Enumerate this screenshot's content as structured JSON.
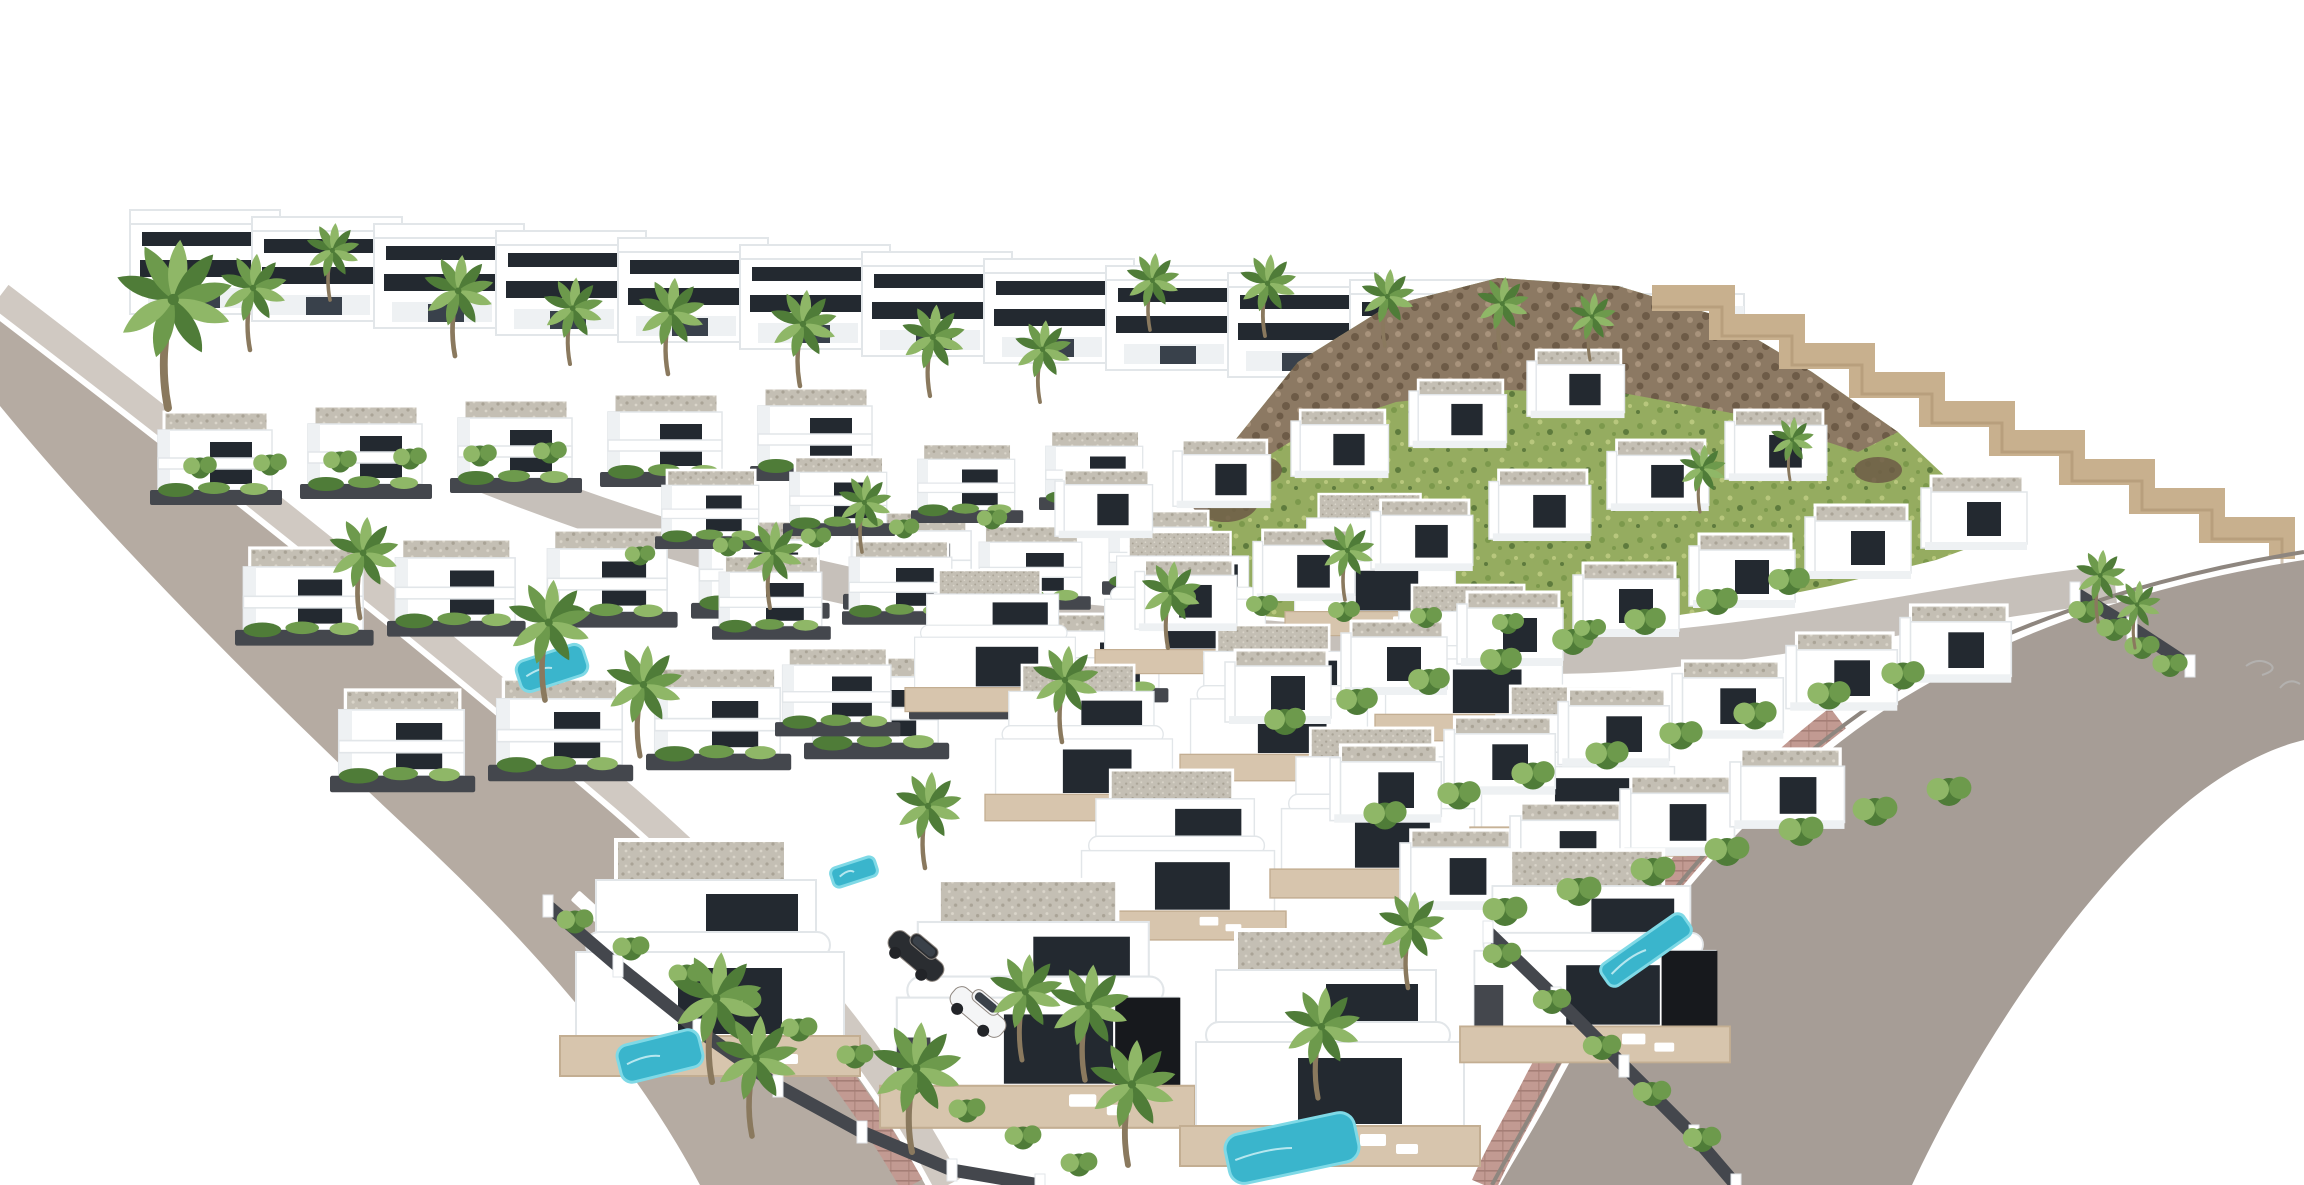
{
  "meta": {
    "title": "Aerial 3D architectural render of a white villa development with palm trees, pools and roads"
  },
  "canvas": {
    "width": 2304,
    "height": 1185,
    "background": "#ffffff"
  },
  "palette": {
    "white": "#ffffff",
    "offWhite": "#eef1f3",
    "shade": "#e2e6e9",
    "glass": "#232930",
    "glassLight": "#39414b",
    "black": "#17191d",
    "roadLeft": "#b5aba2",
    "roadRight": "#a69d96",
    "sidewalk": "#d0c9c2",
    "curbDark": "#8e867f",
    "pink": "#c29a92",
    "pinkLine": "#a57e76",
    "gravelBase": "#c4bfb4",
    "gravelDot1": "#a9a396",
    "gravelDot2": "#dad5ca",
    "wallDark": "#44474d",
    "terrace": "#d7c5ad",
    "terraceLine": "#c3ae92",
    "grassBase": "#95ac60",
    "grassDot1": "#7c994c",
    "grassDot2": "#b8c77d",
    "grassDark": "#5e7b3d",
    "rockBase": "#8c7963",
    "rockDot1": "#6d5b47",
    "rockDot2": "#a8937c",
    "stone": "#c8b08e",
    "stoneLine": "#a88e6c",
    "green1": "#6d9a4c",
    "green2": "#4f7c38",
    "green3": "#8fb767",
    "trunk": "#8a795e",
    "pool": "#3ab5cc",
    "poolLight": "#7fd9e6",
    "carDark": "#2a2d31",
    "carWhite": "#f4f5f6",
    "carGlass": "#3a4149"
  },
  "scene": {
    "top_row": {
      "n": 13,
      "x": 130,
      "y": 210,
      "dx": 122,
      "dy": 7
    },
    "hill": {
      "points": "1185,642 1202,524 1232,444 1298,362 1388,306 1498,278 1618,286 1718,316 1812,372 1898,432 1962,492 2002,536 1936,560 1830,586 1700,612 1560,632 1410,646 1270,650",
      "ridge": "1232,444 1298,362 1388,306 1498,278 1618,286 1718,316 1812,372 1898,432 1858,452 1748,416 1628,394 1508,390 1396,402 1306,432 1258,462",
      "rocks": [
        {
          "cx": 1225,
          "cy": 500,
          "rx": 34,
          "ry": 22
        },
        {
          "cx": 1208,
          "cy": 560,
          "rx": 26,
          "ry": 16
        },
        {
          "cx": 1260,
          "cy": 470,
          "rx": 22,
          "ry": 14
        },
        {
          "cx": 1950,
          "cy": 520,
          "rx": 30,
          "ry": 16
        },
        {
          "cx": 1878,
          "cy": 470,
          "rx": 24,
          "ry": 13
        }
      ]
    },
    "stone_wall": {
      "x": 1652,
      "y": 298,
      "steps": 9,
      "dx": 70,
      "dy": 29,
      "width": 26
    },
    "center_road": {
      "path": "M470,468 C700,560 905,608 1115,626 C1335,645 1490,662 1630,652 C1815,638 1960,600 2115,584",
      "width": 38
    },
    "left_road": {
      "fill": "M0,308 C210,470 420,640 615,810 C760,940 865,1060 935,1185 L700,1185 C640,1072 550,962 418,838 C278,708 108,538 0,406 Z",
      "sidewalk": "M0,296 C215,460 428,630 625,798 C772,926 876,1048 948,1185",
      "pink": "M652,872 C762,972 848,1072 912,1185"
    },
    "right_road": {
      "fill": "M2304,560 C2140,585 1985,640 1870,720 C1745,808 1640,930 1560,1080 C1538,1122 1515,1158 1500,1185 L1912,1185 C1975,1050 2080,890 2190,800 C2230,768 2270,748 2304,740 Z",
      "curb": "M2304,552 C2140,578 1980,632 1862,712 C1738,800 1632,925 1552,1076 C1530,1118 1508,1155 1492,1185",
      "pink": "M1838,718 C1718,810 1615,934 1538,1080 C1518,1120 1498,1152 1484,1185"
    },
    "crosswalk": {
      "w": 62,
      "h": 13,
      "rot": 42,
      "pts": [
        [
          598,
          916
        ],
        [
          623,
          940
        ],
        [
          648,
          964
        ],
        [
          673,
          988
        ],
        [
          698,
          1012
        ]
      ]
    },
    "left_rows": [
      {
        "x": 150,
        "y": 412,
        "n": 5,
        "dx": 150,
        "dy": -6,
        "s": 1.0
      },
      {
        "x": 235,
        "y": 548,
        "n": 5,
        "dx": 152,
        "dy": -9,
        "s": 1.05
      },
      {
        "x": 330,
        "y": 690,
        "n": 4,
        "dx": 158,
        "dy": -11,
        "s": 1.1
      }
    ],
    "mid_rows": [
      {
        "x": 655,
        "y": 470,
        "n": 4,
        "dx": 128,
        "dy": -13,
        "s": 0.85
      },
      {
        "x": 712,
        "y": 556,
        "n": 4,
        "dx": 130,
        "dy": -15,
        "s": 0.9
      },
      {
        "x": 775,
        "y": 648,
        "n": 3,
        "dx": 134,
        "dy": -17,
        "s": 0.95
      }
    ],
    "center_big": [
      {
        "x": 905,
        "y": 570,
        "n": 3,
        "dx": 190,
        "dy": -38,
        "s": 0.6
      },
      {
        "x": 985,
        "y": 665,
        "n": 3,
        "dx": 195,
        "dy": -40,
        "s": 0.66
      },
      {
        "x": 1070,
        "y": 770,
        "n": 3,
        "dx": 200,
        "dy": -42,
        "s": 0.72
      }
    ],
    "right_rows": [
      {
        "x": 1055,
        "y": 470,
        "n": 5,
        "dx": 118,
        "dy": -30,
        "s": 0.92
      },
      {
        "x": 1135,
        "y": 560,
        "n": 6,
        "dx": 118,
        "dy": -30,
        "s": 0.96
      },
      {
        "x": 1225,
        "y": 650,
        "n": 7,
        "dx": 116,
        "dy": -29,
        "s": 1.0
      },
      {
        "x": 1330,
        "y": 745,
        "n": 6,
        "dx": 114,
        "dy": -28,
        "s": 1.05
      },
      {
        "x": 1400,
        "y": 830,
        "n": 4,
        "dx": 110,
        "dy": -27,
        "s": 1.08
      }
    ],
    "foreground_villas": [
      {
        "x": 560,
        "y": 840,
        "s": 1.0,
        "black": false
      },
      {
        "x": 880,
        "y": 880,
        "s": 1.05,
        "black": true
      },
      {
        "x": 1180,
        "y": 930,
        "s": 1.0,
        "black": false
      },
      {
        "x": 1460,
        "y": 850,
        "s": 0.9,
        "black": true
      }
    ],
    "fg_walls": [
      {
        "pts": [
          [
            548,
            906
          ],
          [
            618,
            966
          ],
          [
            698,
            1030
          ],
          [
            778,
            1086
          ],
          [
            862,
            1132
          ],
          [
            952,
            1170
          ],
          [
            1040,
            1185
          ]
        ]
      },
      {
        "pts": [
          [
            1488,
            932
          ],
          [
            1556,
            998
          ],
          [
            1624,
            1066
          ],
          [
            1694,
            1136
          ],
          [
            1736,
            1185
          ]
        ]
      },
      {
        "pts": [
          [
            2075,
            593
          ],
          [
            2132,
            628
          ],
          [
            2190,
            666
          ]
        ]
      }
    ],
    "hedges": [
      {
        "x": 575,
        "y": 922,
        "n": 10,
        "dx": 56,
        "dy": 27,
        "s": 1.15
      },
      {
        "x": 1502,
        "y": 956,
        "n": 5,
        "dx": 50,
        "dy": 46,
        "s": 1.2
      },
      {
        "x": 1285,
        "y": 722,
        "n": 8,
        "dx": 72,
        "dy": -20,
        "s": 1.3
      },
      {
        "x": 1385,
        "y": 816,
        "n": 8,
        "dx": 74,
        "dy": -20,
        "s": 1.35
      },
      {
        "x": 1505,
        "y": 912,
        "n": 7,
        "dx": 74,
        "dy": -20,
        "s": 1.4
      },
      {
        "x": 2086,
        "y": 612,
        "n": 4,
        "dx": 28,
        "dy": 18,
        "s": 1.1
      },
      {
        "x": 200,
        "y": 468,
        "n": 6,
        "dx": 70,
        "dy": -3,
        "s": 1.05
      },
      {
        "x": 1180,
        "y": 600,
        "n": 6,
        "dx": 82,
        "dy": 6,
        "s": 1.0
      },
      {
        "x": 640,
        "y": 556,
        "n": 5,
        "dx": 88,
        "dy": -9,
        "s": 0.95
      }
    ],
    "pools": [
      {
        "x": 552,
        "y": 668,
        "w": 70,
        "h": 32,
        "rot": -18
      },
      {
        "x": 854,
        "y": 872,
        "w": 46,
        "h": 20,
        "rot": -18
      },
      {
        "x": 660,
        "y": 1056,
        "w": 84,
        "h": 38,
        "rot": -14
      },
      {
        "x": 1292,
        "y": 1148,
        "w": 132,
        "h": 50,
        "rot": -12
      },
      {
        "x": 1646,
        "y": 950,
        "w": 100,
        "h": 26,
        "rot": -35
      }
    ],
    "cars": [
      {
        "x": 916,
        "y": 956,
        "rot": 40,
        "type": "dark"
      },
      {
        "x": 978,
        "y": 1012,
        "rot": 40,
        "type": "white"
      }
    ],
    "palms": [
      [
        168,
        408,
        1.75
      ],
      [
        250,
        350,
        1.0
      ],
      [
        330,
        300,
        0.8
      ],
      [
        455,
        356,
        1.05
      ],
      [
        570,
        364,
        0.9
      ],
      [
        668,
        374,
        1.0
      ],
      [
        800,
        386,
        1.0
      ],
      [
        930,
        396,
        0.95
      ],
      [
        1040,
        402,
        0.85
      ],
      [
        1150,
        330,
        0.8
      ],
      [
        1265,
        336,
        0.85
      ],
      [
        1385,
        346,
        0.8
      ],
      [
        1500,
        352,
        0.78
      ],
      [
        1590,
        360,
        0.7
      ],
      [
        360,
        618,
        1.05
      ],
      [
        545,
        700,
        1.25
      ],
      [
        640,
        756,
        1.15
      ],
      [
        770,
        608,
        0.9
      ],
      [
        862,
        552,
        0.8
      ],
      [
        1062,
        742,
        1.0
      ],
      [
        925,
        868,
        1.0
      ],
      [
        1168,
        648,
        0.9
      ],
      [
        1345,
        600,
        0.8
      ],
      [
        1700,
        512,
        0.7
      ],
      [
        1790,
        480,
        0.65
      ],
      [
        2098,
        622,
        0.75
      ],
      [
        2135,
        648,
        0.7
      ],
      [
        712,
        1082,
        1.35
      ],
      [
        752,
        1136,
        1.25
      ],
      [
        912,
        1152,
        1.35
      ],
      [
        1085,
        1080,
        1.2
      ],
      [
        1128,
        1165,
        1.3
      ],
      [
        1318,
        1098,
        1.15
      ],
      [
        1408,
        988,
        1.0
      ],
      [
        1022,
        1060,
        1.1
      ]
    ],
    "squiggles": [
      "M2246,666 q12,-9 24,-2 q8,6 -8,11",
      "M2280,688 q9,-11 20,-4"
    ]
  }
}
